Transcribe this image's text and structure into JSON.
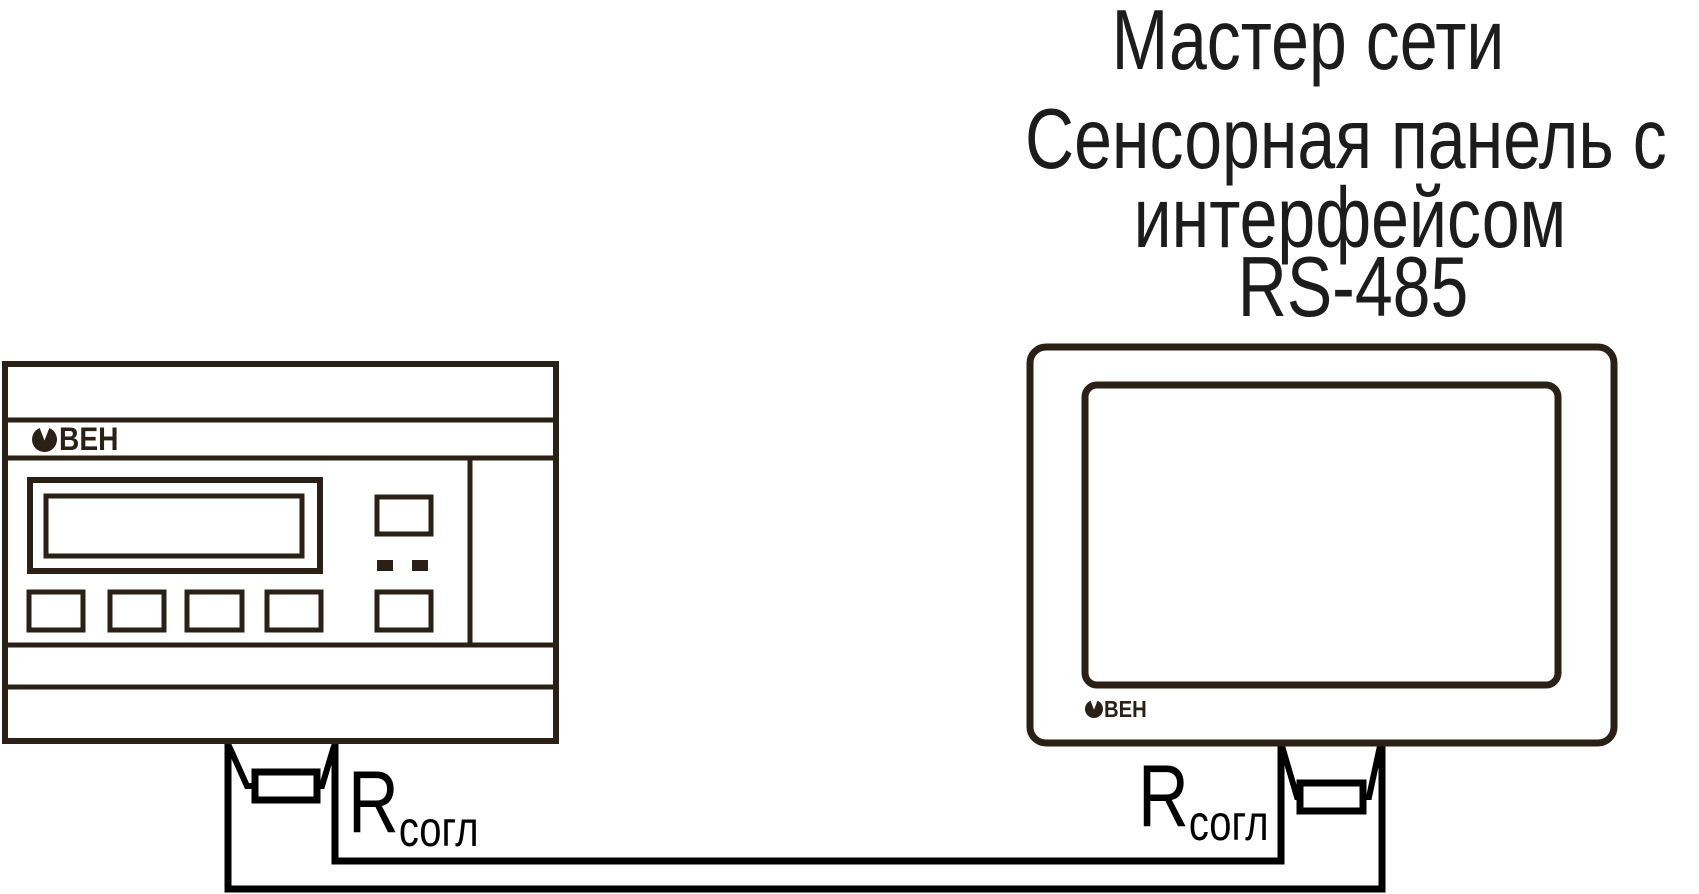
{
  "title_block": {
    "master": "Мастер сети",
    "panel_line1": "Сенсорная панель с",
    "panel_line2": "интерфейсом",
    "panel_line3": "RS-485"
  },
  "labels": {
    "resistor_symbol": "R",
    "resistor_subscript": "согл"
  },
  "brand": {
    "letters": "ВЕН"
  },
  "colors": {
    "device_outline": "#2b2016",
    "wire": "#000000",
    "text": "#1c1c1c"
  }
}
